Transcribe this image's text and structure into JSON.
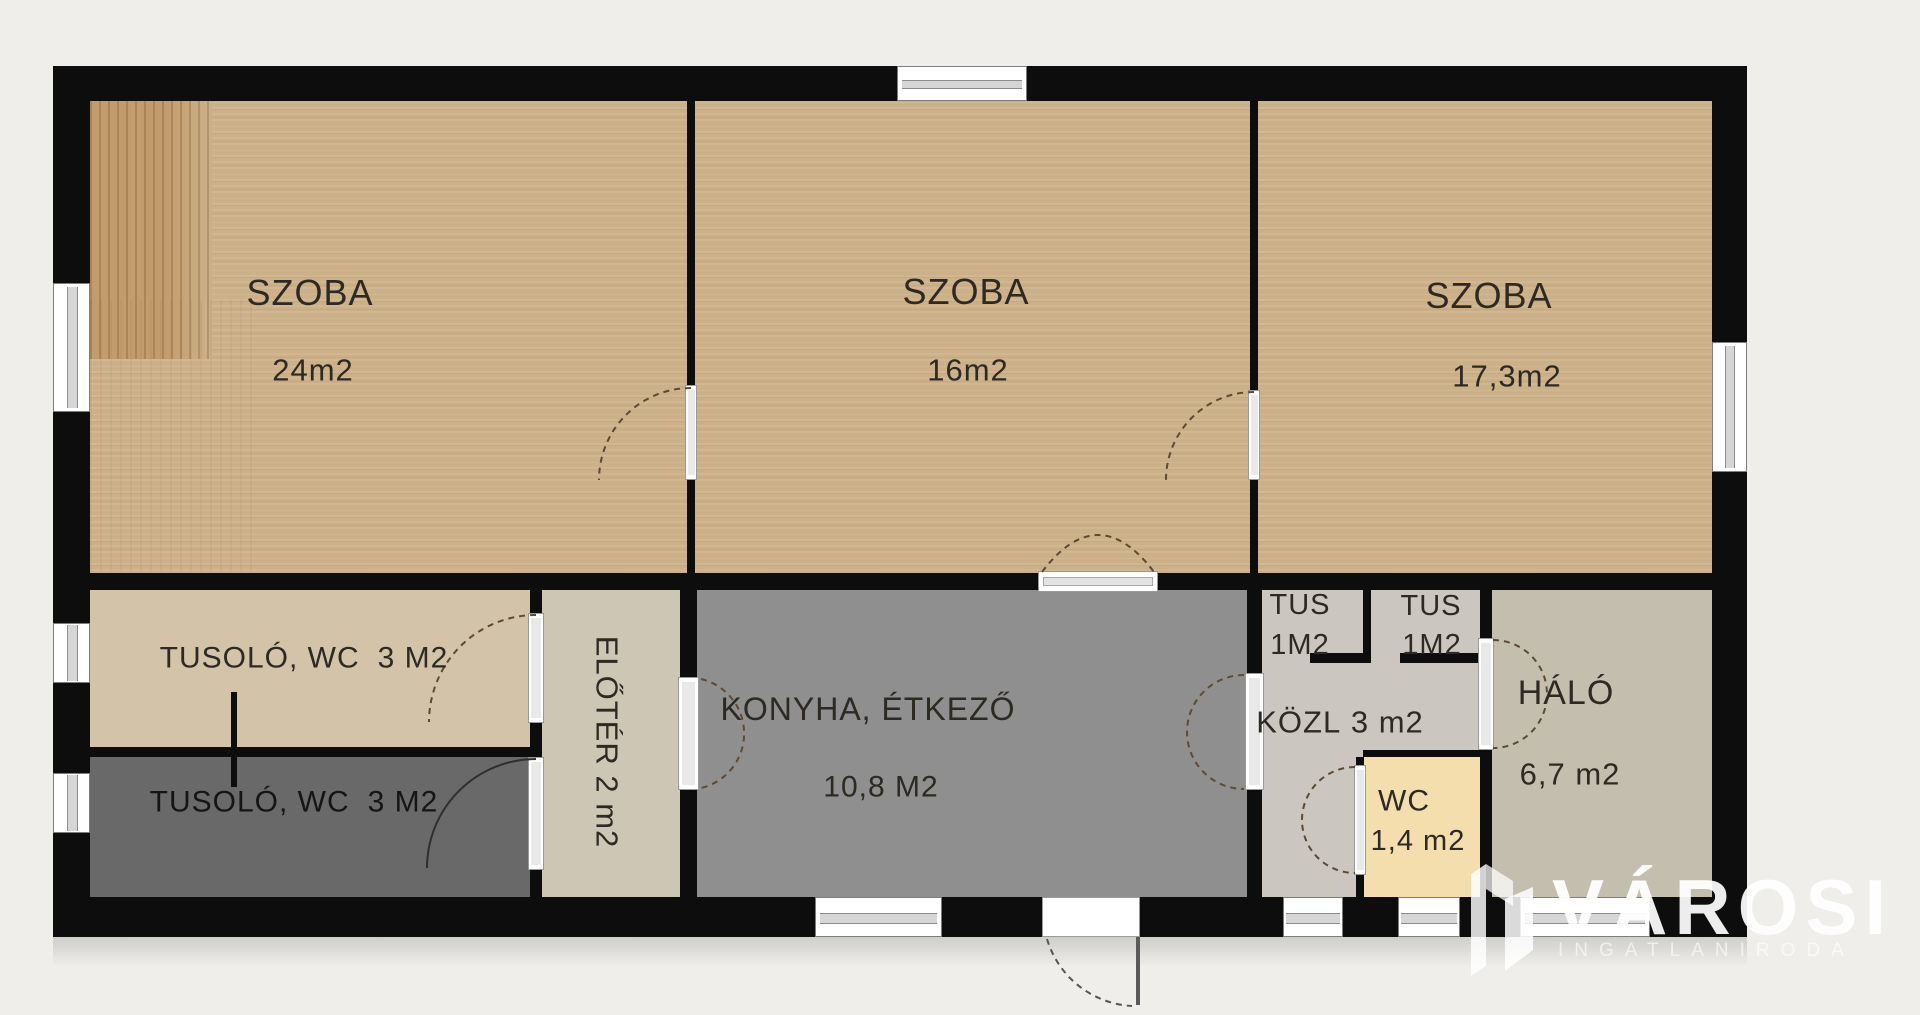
{
  "rooms": {
    "szoba1": {
      "name": "SZOBA",
      "area": "24m2"
    },
    "szoba2": {
      "name": "SZOBA",
      "area": "16m2"
    },
    "szoba3": {
      "name": "SZOBA",
      "area": "17,3m2"
    },
    "tusolo_felso": {
      "name": "TUSOLÓ, WC",
      "area": "3 M2"
    },
    "tusolo_also": {
      "name": "TUSOLÓ, WC",
      "area": "3 M2"
    },
    "eloter": {
      "name": "ELŐTÉR",
      "area": "2 m2"
    },
    "konyha": {
      "name": "KONYHA, ÉTKEZŐ",
      "area": "10,8 M2"
    },
    "tus1": {
      "name": "TUS",
      "area": "1M2"
    },
    "tus2": {
      "name": "TUS",
      "area": "1M2"
    },
    "kozl": {
      "name": "KÖZL",
      "area": "3 m2"
    },
    "halo": {
      "name": "HÁLÓ",
      "area": "6,7 m2"
    },
    "wc": {
      "name": "WC",
      "area": "1,4 m2"
    }
  },
  "logo": {
    "brand": "VÁROSI",
    "subtitle": "INGATLANIRODA"
  },
  "colors": {
    "background": "#efeeea",
    "walls": "#0d0d0d",
    "szoba_floor": "#ccb088",
    "wood_patch": "#c39c6d",
    "tusolo_felso_floor": "#d2c3a9",
    "tusolo_also_floor": "#696969",
    "eloter_floor": "#cdc6b4",
    "konyha_floor": "#8f8f8f",
    "kozl_floor": "#cbc7c0",
    "wc_floor": "#f4deae",
    "halo_floor": "#c4beaf",
    "logo_white": "#ffffff"
  }
}
